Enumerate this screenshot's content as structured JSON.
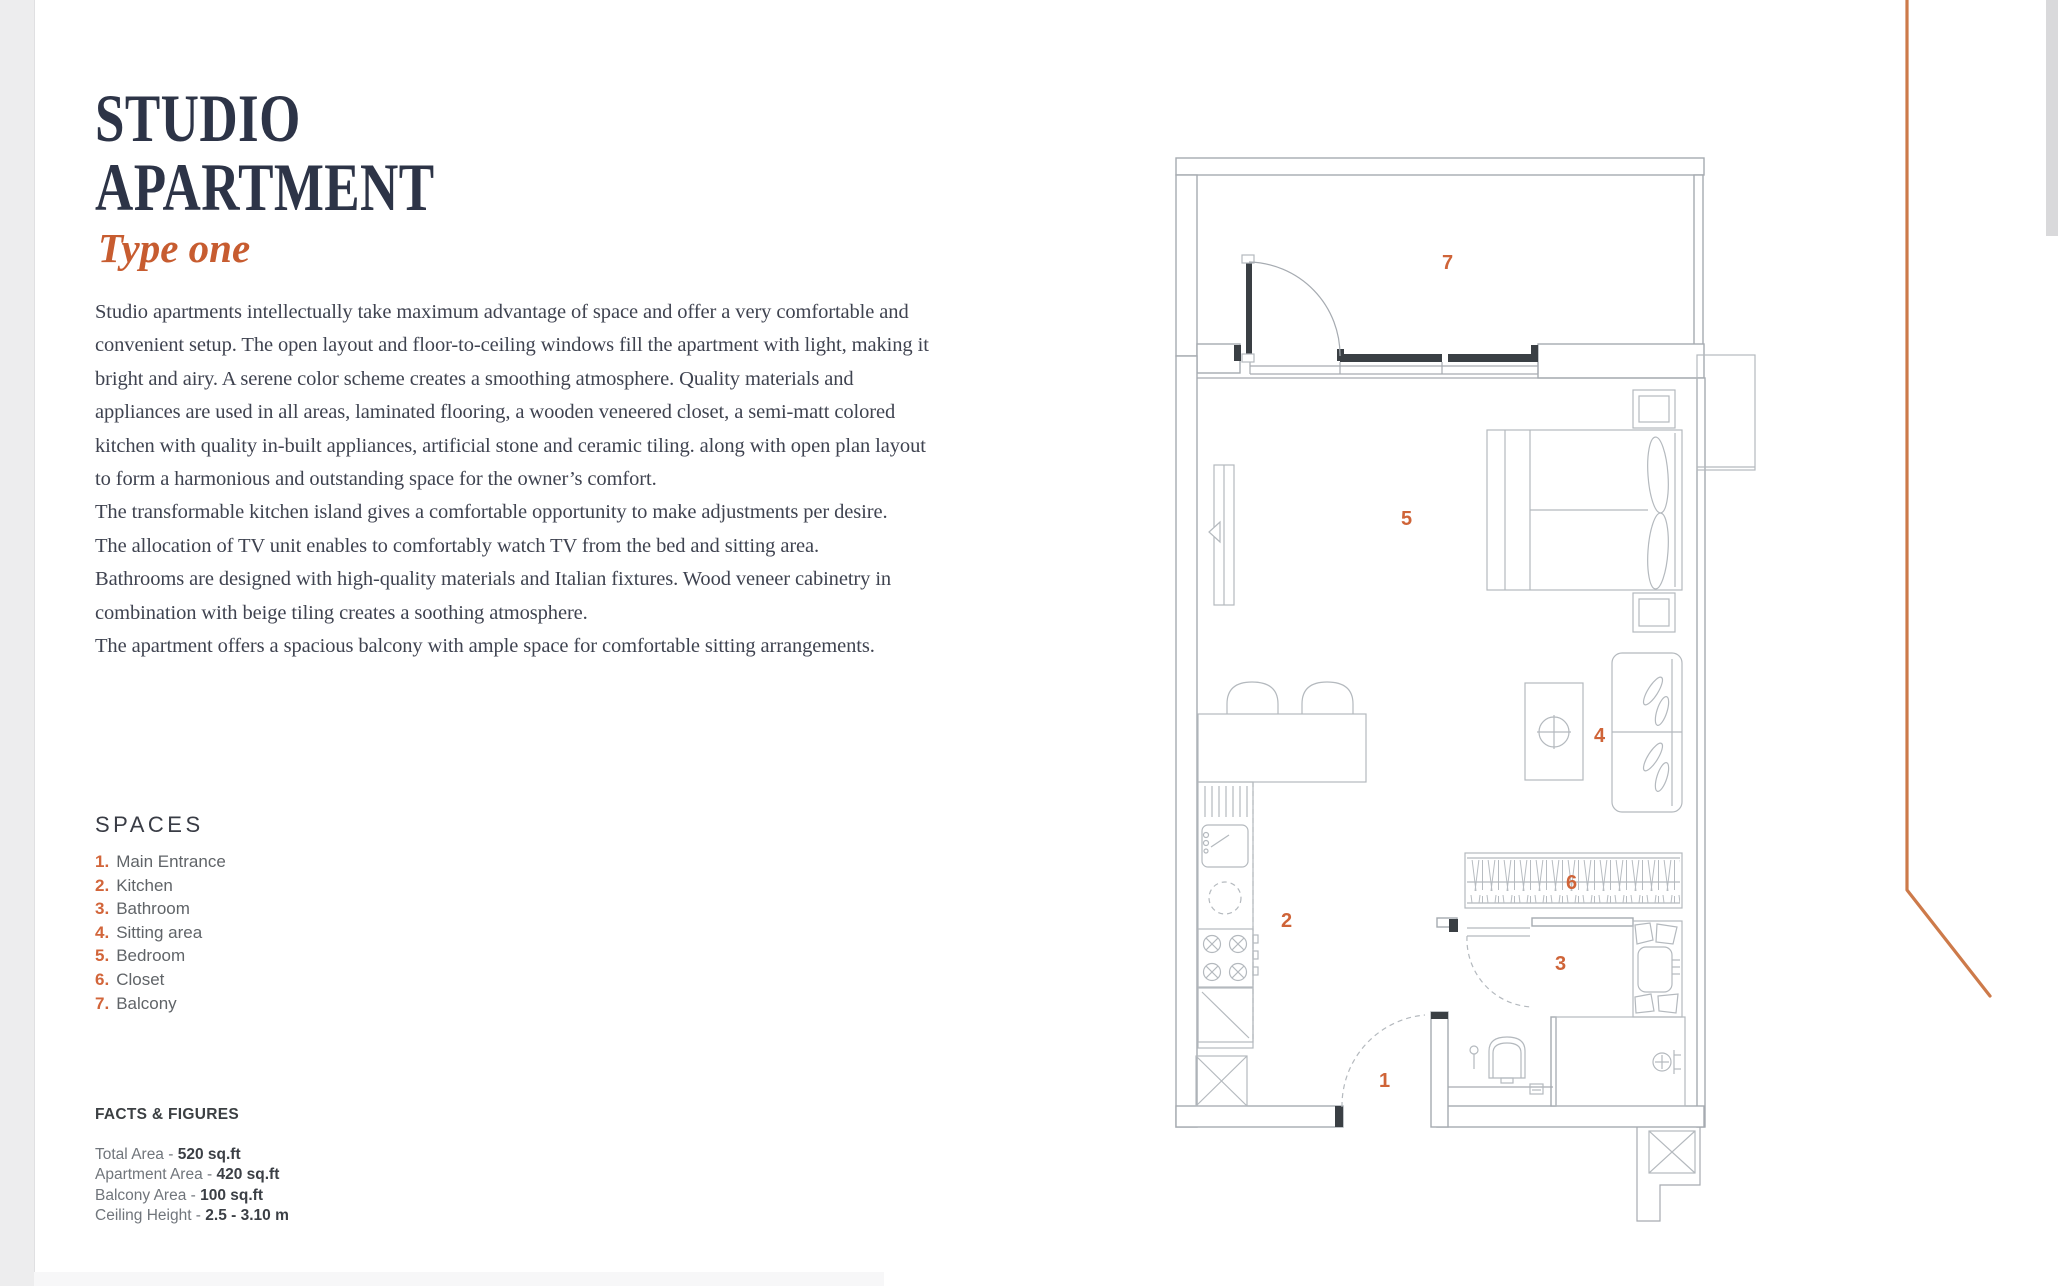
{
  "header": {
    "title_line1": "STUDIO",
    "title_line2": "APARTMENT",
    "subtitle": "Type one"
  },
  "description": {
    "paragraphs": [
      "Studio apartments intellectually take maximum advantage of space and offer a very comfortable and convenient setup. The open layout and floor-to-ceiling windows fill the apartment with light, making it bright and airy. A serene color scheme creates a smoothing atmosphere. Quality materials and appliances are used in all areas, laminated flooring, a wooden veneered closet, a semi-matt colored kitchen with quality in-built appliances, artificial stone and ceramic tiling. along with open plan layout to form a harmonious and outstanding space for the owner’s comfort.",
      "The transformable kitchen island gives a comfortable opportunity to make adjustments per desire.",
      "The allocation of TV unit enables to comfortably watch TV from the bed and sitting area.",
      "Bathrooms are designed with high-quality materials and Italian fixtures. Wood veneer cabinetry in combination with beige tiling creates a soothing atmosphere.",
      "The apartment offers a spacious balcony with ample space for comfortable sitting arrangements."
    ]
  },
  "spaces": {
    "heading": "SPACES",
    "items": [
      {
        "num": "1.",
        "label": "Main Entrance"
      },
      {
        "num": "2.",
        "label": "Kitchen"
      },
      {
        "num": "3.",
        "label": "Bathroom"
      },
      {
        "num": "4.",
        "label": "Sitting area"
      },
      {
        "num": "5.",
        "label": "Bedroom"
      },
      {
        "num": "6.",
        "label": "Closet"
      },
      {
        "num": "7.",
        "label": "Balcony"
      }
    ]
  },
  "facts": {
    "heading": "FACTS & FIGURES",
    "items": [
      {
        "label": "Total Area - ",
        "value": "520 sq.ft"
      },
      {
        "label": "Apartment Area - ",
        "value": "420 sq.ft"
      },
      {
        "label": "Balcony Area - ",
        "value": "100 sq.ft"
      },
      {
        "label": "Ceiling Height - ",
        "value": "2.5 - 3.10 m"
      }
    ]
  },
  "floorplan": {
    "labels": [
      "1",
      "2",
      "3",
      "4",
      "5",
      "6",
      "7"
    ]
  },
  "colors": {
    "accent_orange": "#c75c30",
    "plan_label_orange": "#cf6438",
    "title_navy": "#2d3447"
  }
}
